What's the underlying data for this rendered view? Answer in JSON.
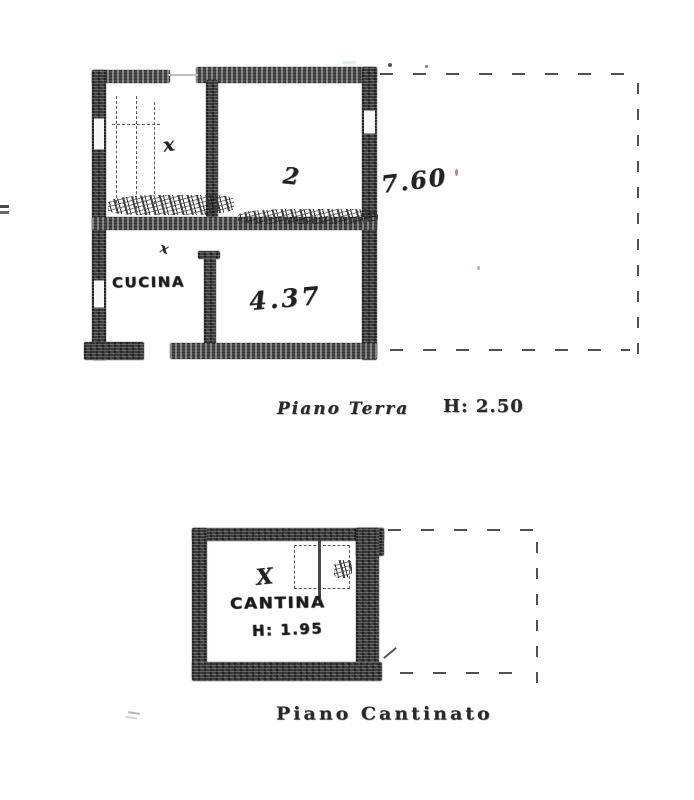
{
  "plans": {
    "ground_floor": {
      "rooms": {
        "kitchen_label": "CUCINA"
      },
      "marks": {
        "upper_room_mark": "x",
        "living_room_mark": "2",
        "kitchen_door_mark": "x",
        "basement_room_mark": "X"
      },
      "dimensions": {
        "depth": "7.60",
        "width": "4.37"
      },
      "caption": {
        "title": "Piano Terra",
        "height_note": "H: 2.50"
      }
    },
    "basement": {
      "rooms": {
        "cellar_label": "CANTINA"
      },
      "dimensions": {
        "height": "H: 1.95"
      },
      "caption": {
        "title": "Piano Cantinato"
      }
    }
  },
  "colors": {
    "paper": "#ffffff",
    "ink": "#2a2a2a",
    "wall": "#3a3a3a",
    "dashed_line": "#4d4d4d",
    "red_speck": "#c97f7f",
    "blue_smudge": "#dcebf5"
  }
}
